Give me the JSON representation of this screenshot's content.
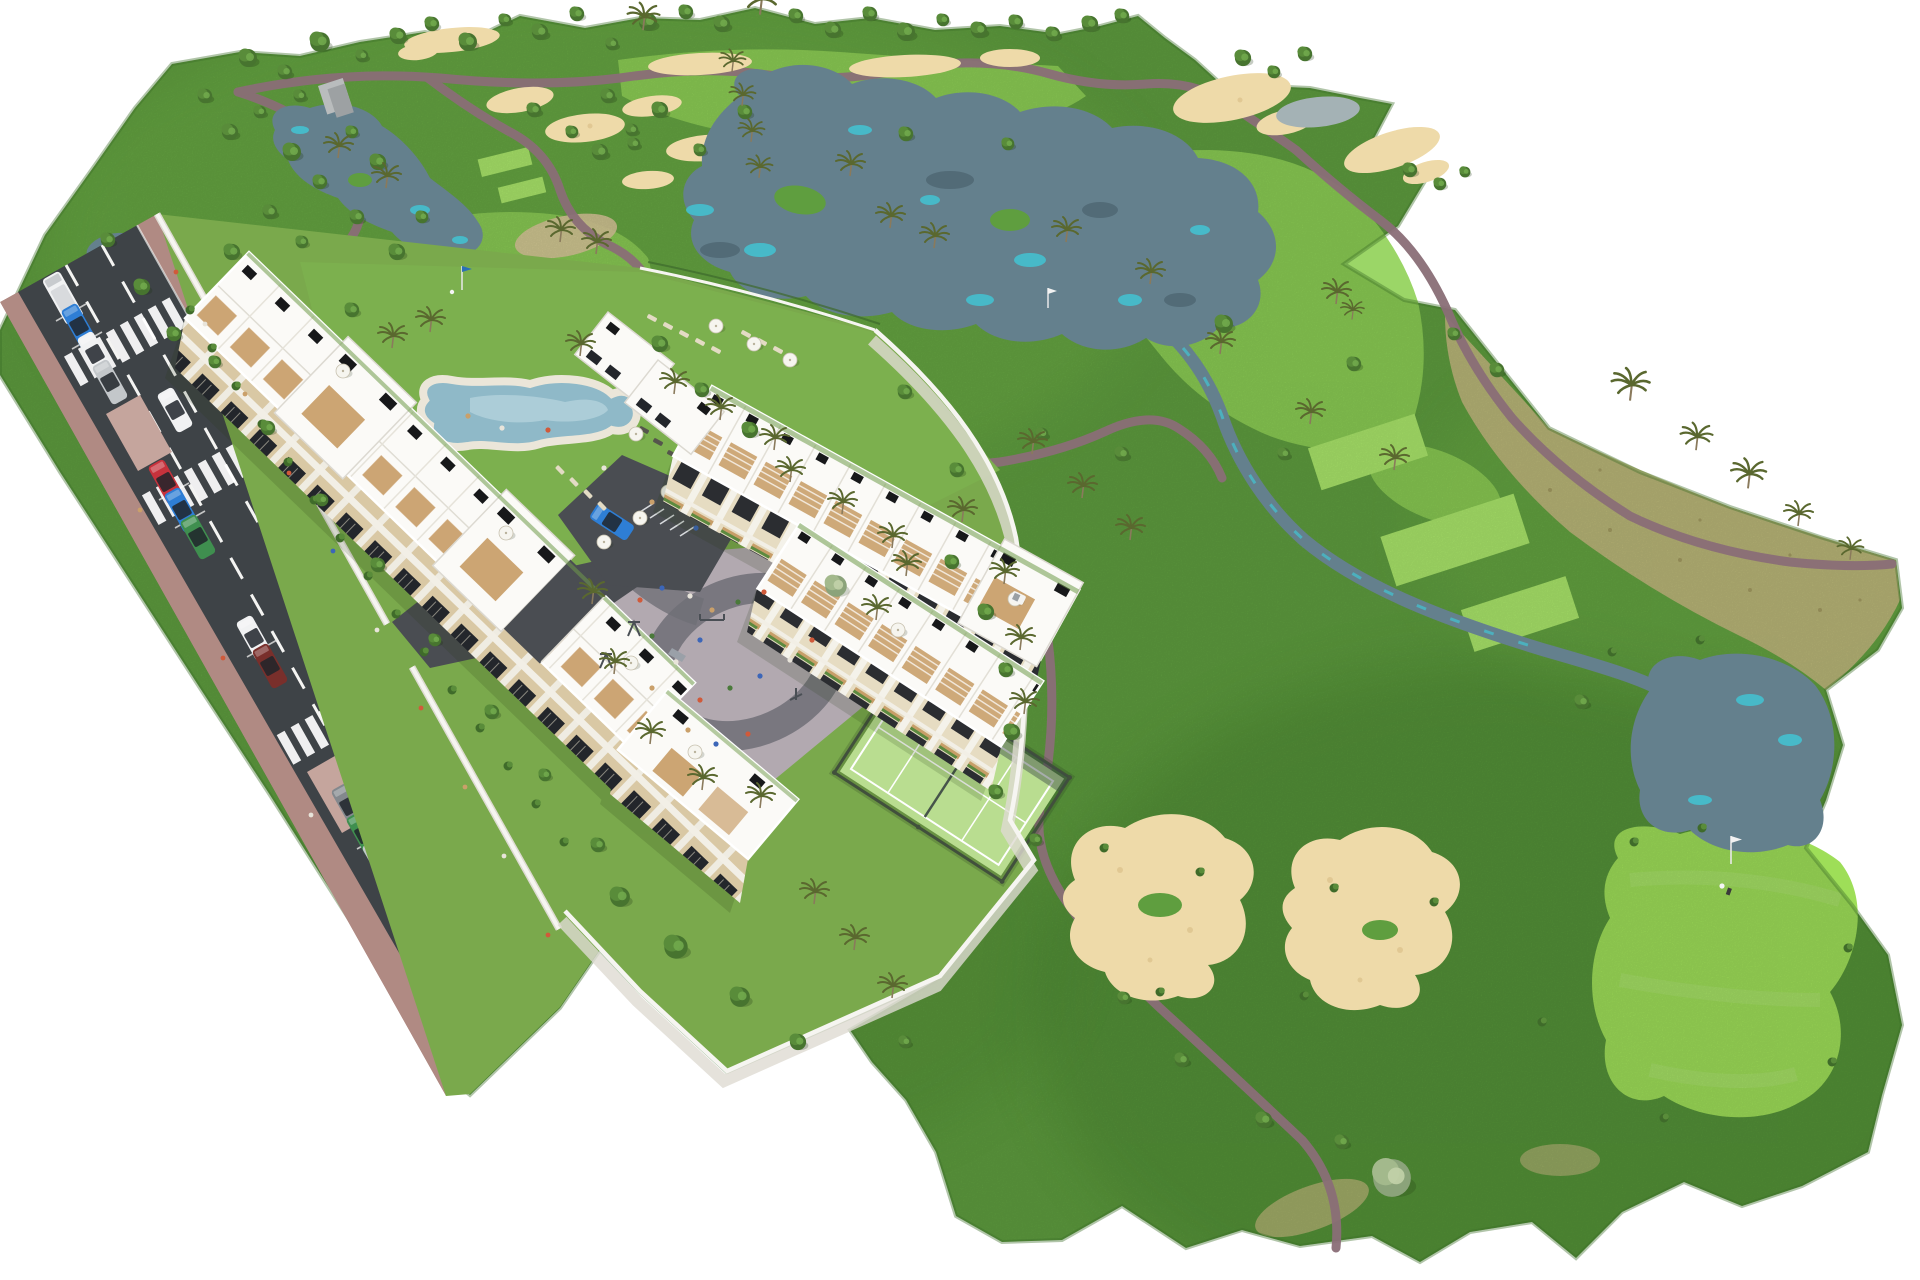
{
  "title": "Aerial 3D render of a golf resort apartment development",
  "subtitle": "Bird's-eye masterplan view: apartment blocks beside a golf course with lakes, bunkers, pool, playground and padel court",
  "scene": {
    "amenities": [
      "golf course",
      "lakes and streams",
      "sand bunkers",
      "putting greens",
      "lagoon pool with sun loungers",
      "playground plaza",
      "padel tennis court",
      "street with parking"
    ],
    "buildings": [
      "long apartment row along the street",
      "terraced golf-facing row",
      "second terraced row",
      "corner block with roof terraces"
    ],
    "cars_parked": [
      "white van",
      "blue",
      "white",
      "silver",
      "red",
      "blue",
      "green",
      "white",
      "maroon",
      "gray",
      "green",
      "silver",
      "brown"
    ],
    "cars_moving": [
      "white",
      "silver",
      "green",
      "gray",
      "dark blue"
    ],
    "golfers_visible": 2,
    "flags_visible": 3
  },
  "colors": {
    "bg": "#ffffff",
    "grass": "#5f9e3f",
    "grassLight": "#7abc4c",
    "grassDark": "#3f7a2b",
    "devLawn": "#7aa94c",
    "fairway": "#90d157",
    "tee": "#abe76b",
    "green": "#9ede58",
    "dry": "#c3b97e",
    "drySpeck": "#9b9159",
    "sand": "#eedaa9",
    "sandDark": "#d8bd85",
    "water": "#64808d",
    "waterDark": "#4e6572",
    "waterTeal": "#42c4d3",
    "waterPale": "#a4b2b5",
    "pool": "#8fb9c8",
    "poolLight": "#b8d6de",
    "poolDeck": "#ebe6d9",
    "path": "#8a6e77",
    "road": "#3e4347",
    "roadLine": "#f4f4f2",
    "sidewalk": "#b08a83",
    "sidewalkLight": "#c5a59d",
    "plaza": "#b2a9b0",
    "plazaBand": "#6f6f77",
    "wall": "#f6f5f1",
    "wallShade": "#dedbd2",
    "roof": "#fbfaf7",
    "roofShade": "#e8e6df",
    "facade": "#d9c8a4",
    "facadeB": "#e6dcc2",
    "win": "#23262b",
    "deck": "#c9a06c",
    "panel": "#17181a",
    "court": "#b9dd90",
    "courtFence": "#41503c",
    "tree": "#47742f",
    "treeMid": "#598c3a",
    "treeLight": "#70a94d",
    "treeGray": "#8ba37a",
    "bush": "#3f6b2a",
    "palm": "#5a682f",
    "trunk": "#8a7a5c",
    "umbrella": "#f6f5ef",
    "lounger": "#e3dbc4",
    "loungerDark": "#55554c",
    "carWhite": "#f1f2f3",
    "carSilver": "#c3c7ca",
    "carGray": "#83888d",
    "carRed": "#c7323c",
    "carBlue": "#2e7ed5",
    "carDarkBlue": "#323c8f",
    "carGreen": "#3f8f4f",
    "carMaroon": "#792f2b",
    "carBrown": "#8a6a4a",
    "peopleA": "#d05a3a",
    "peopleB": "#3c66b8",
    "peopleC": "#e8e4da",
    "peopleD": "#caa06a",
    "peopleE": "#4a7a3a"
  }
}
